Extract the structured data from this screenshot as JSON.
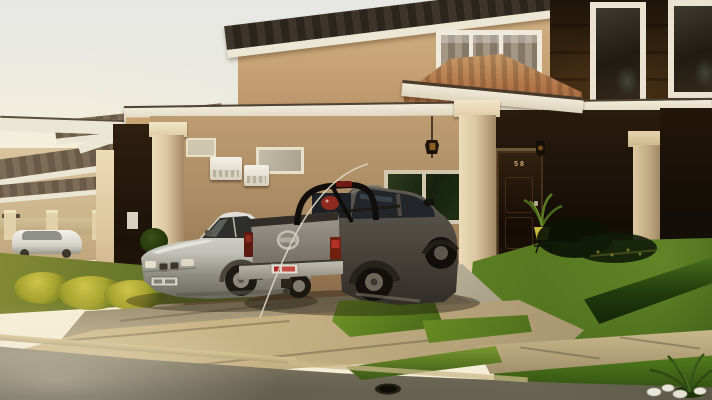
{
  "scene": {
    "description": "Sunlit two-story residential house with attached carport, dark brown accent walls and white trim; a gray double-cab pickup truck and a silver sedan are parked on the driveway; neighboring houses, fence and a white hatchback at left; green lawns, hedges, concrete driveway, sidewalk and street in front",
    "house_number": "58"
  },
  "vehicles": {
    "pickup": {
      "kind": "double-cab pickup truck",
      "body_color": "#57534a",
      "emblem": "nissan-logo",
      "license_plate": {
        "bg": "#dedbd0",
        "text_color": "#c03026"
      }
    },
    "sedan": {
      "kind": "luxury sedan",
      "body_color": "#c6c4bc",
      "emblem": "bmw-kidney-grille",
      "license_plate": {
        "bg": "#d2cfc4",
        "text_color": "#4a473c"
      }
    },
    "background_car": {
      "kind": "hatchback",
      "body_color": "#efede6"
    }
  },
  "palette": {
    "sky": "#eceadf",
    "wall_tan": "#c5a173",
    "wall_dark_brown": "#32210f",
    "trim_white": "#ece6d4",
    "column_cream": "#dcc8a2",
    "roof_tile_dark": "#352c22",
    "roof_tile_terracotta": "#b5794a",
    "grass_sunlit": "#5d8022",
    "grass_shaded": "#3e5c18",
    "driveway_concrete": "#c6b183",
    "street_asphalt": "#6f6a58",
    "door_brown": "#1c1209"
  }
}
